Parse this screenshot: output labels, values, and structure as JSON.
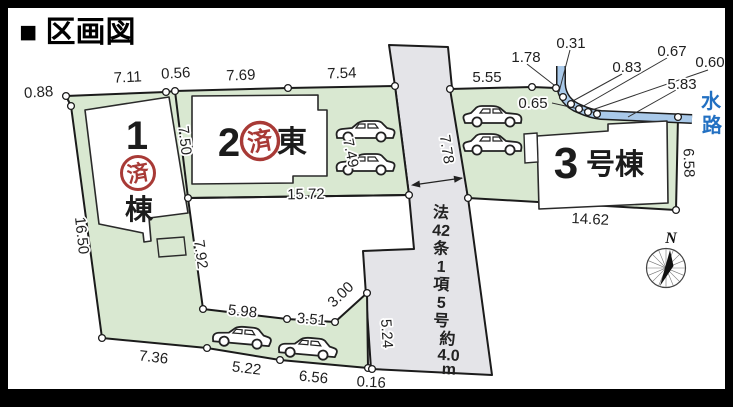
{
  "title": "■ 区画図",
  "compass": {
    "label": "N"
  },
  "water": {
    "chars": [
      "水",
      "路"
    ]
  },
  "stamp": {
    "label": "済"
  },
  "road": {
    "col1": [
      "法",
      "42",
      "条",
      "1",
      "項",
      "5",
      "号"
    ],
    "col2": [
      "約",
      "4.0",
      "m"
    ]
  },
  "parcels": {
    "p1": {
      "num": "1",
      "suffix": "棟"
    },
    "p2": {
      "num": "2",
      "suffix": "東"
    },
    "p3": {
      "num": "3",
      "suffix": "号棟"
    }
  },
  "dims": [
    {
      "t": "0.88"
    },
    {
      "t": "7.11"
    },
    {
      "t": "0.56"
    },
    {
      "t": "7.69"
    },
    {
      "t": "7.54"
    },
    {
      "t": "5.55"
    },
    {
      "t": "1.78"
    },
    {
      "t": "0.31"
    },
    {
      "t": "0.83"
    },
    {
      "t": "0.67"
    },
    {
      "t": "0.60"
    },
    {
      "t": "5.83"
    },
    {
      "t": "0.65"
    },
    {
      "t": "7.50"
    },
    {
      "t": "15.72"
    },
    {
      "t": "7.49"
    },
    {
      "t": "7.78"
    },
    {
      "t": "16.50"
    },
    {
      "t": "7.92"
    },
    {
      "t": "5.98"
    },
    {
      "t": "3.51"
    },
    {
      "t": "3.00"
    },
    {
      "t": "5.24"
    },
    {
      "t": "7.36"
    },
    {
      "t": "5.22"
    },
    {
      "t": "6.56"
    },
    {
      "t": "0.16"
    },
    {
      "t": "14.62"
    },
    {
      "t": "6.58"
    }
  ],
  "colors": {
    "parcel_green": "#d9e8d1",
    "road_gray": "#e4e4e8",
    "water_blue": "#a9c9e9",
    "water_text": "#2270c2",
    "stamp_red": "#a83a36",
    "outline": "#1b1b1b"
  }
}
